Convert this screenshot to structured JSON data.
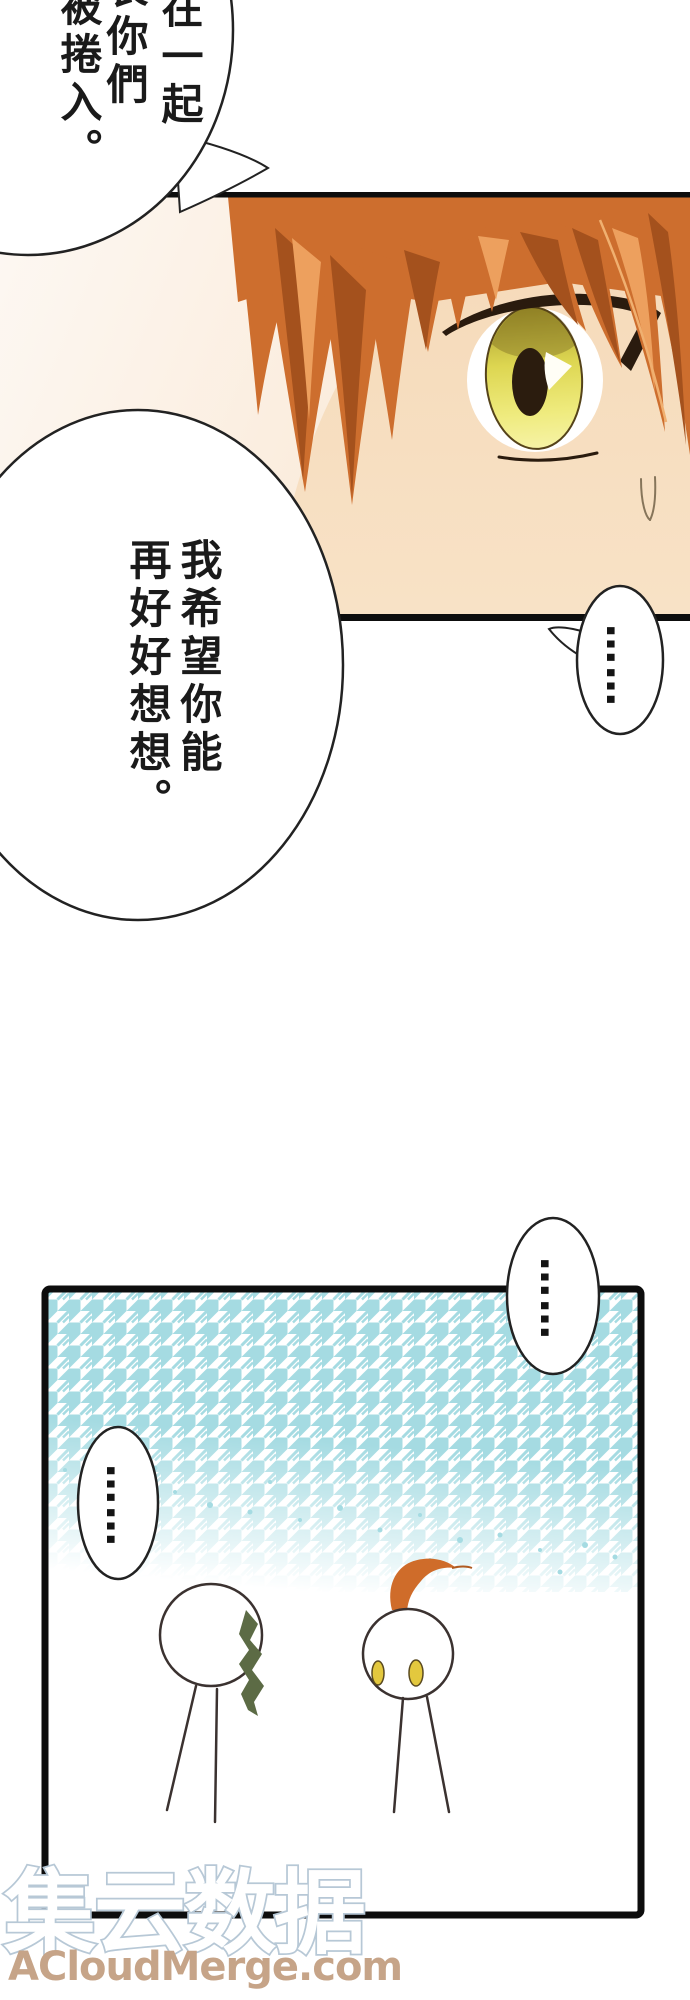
{
  "page": {
    "kind": "manga page",
    "background": "#ffffff",
    "ink_color": "#0d0d0d"
  },
  "panels": {
    "face_closeup": {
      "description": "close-up of orange-haired character's eye with sweat drop",
      "skin_color": "#f6dcbd",
      "hair_color": "#cd6e2e",
      "hair_shadow_color": "#a4511d",
      "hair_highlight_color": "#eda05e",
      "eye_color": "#e8e257",
      "border_color": "#0d0d0d"
    },
    "chibi_scene": {
      "description": "two chibi stick figures on houndstooth backdrop",
      "pattern": "houndstooth",
      "pattern_color": "#a5dbe2",
      "border_color": "#0d0d0d",
      "left_chibi_hair_color": "#5c6b45",
      "right_chibi_hair_color": "#cf6c2a",
      "right_chibi_eye_color": "#e3c83e"
    }
  },
  "speech": {
    "top_bubble": {
      "lines": [
        "在一起",
        "表你們",
        "被捲入。"
      ]
    },
    "main_bubble": {
      "lines": [
        "我希望你能",
        "再好好想想。"
      ]
    },
    "face_ellipsis_bubble": {
      "text": "……"
    },
    "right_ellipsis_bubble": {
      "text": "……"
    },
    "left_ellipsis_bubble": {
      "text": "……"
    }
  },
  "watermark": {
    "site_name": "集云数据",
    "site_url": "ACloudMerge.com",
    "outline_color": "#b7c8d6",
    "url_color": "#c6a488"
  }
}
